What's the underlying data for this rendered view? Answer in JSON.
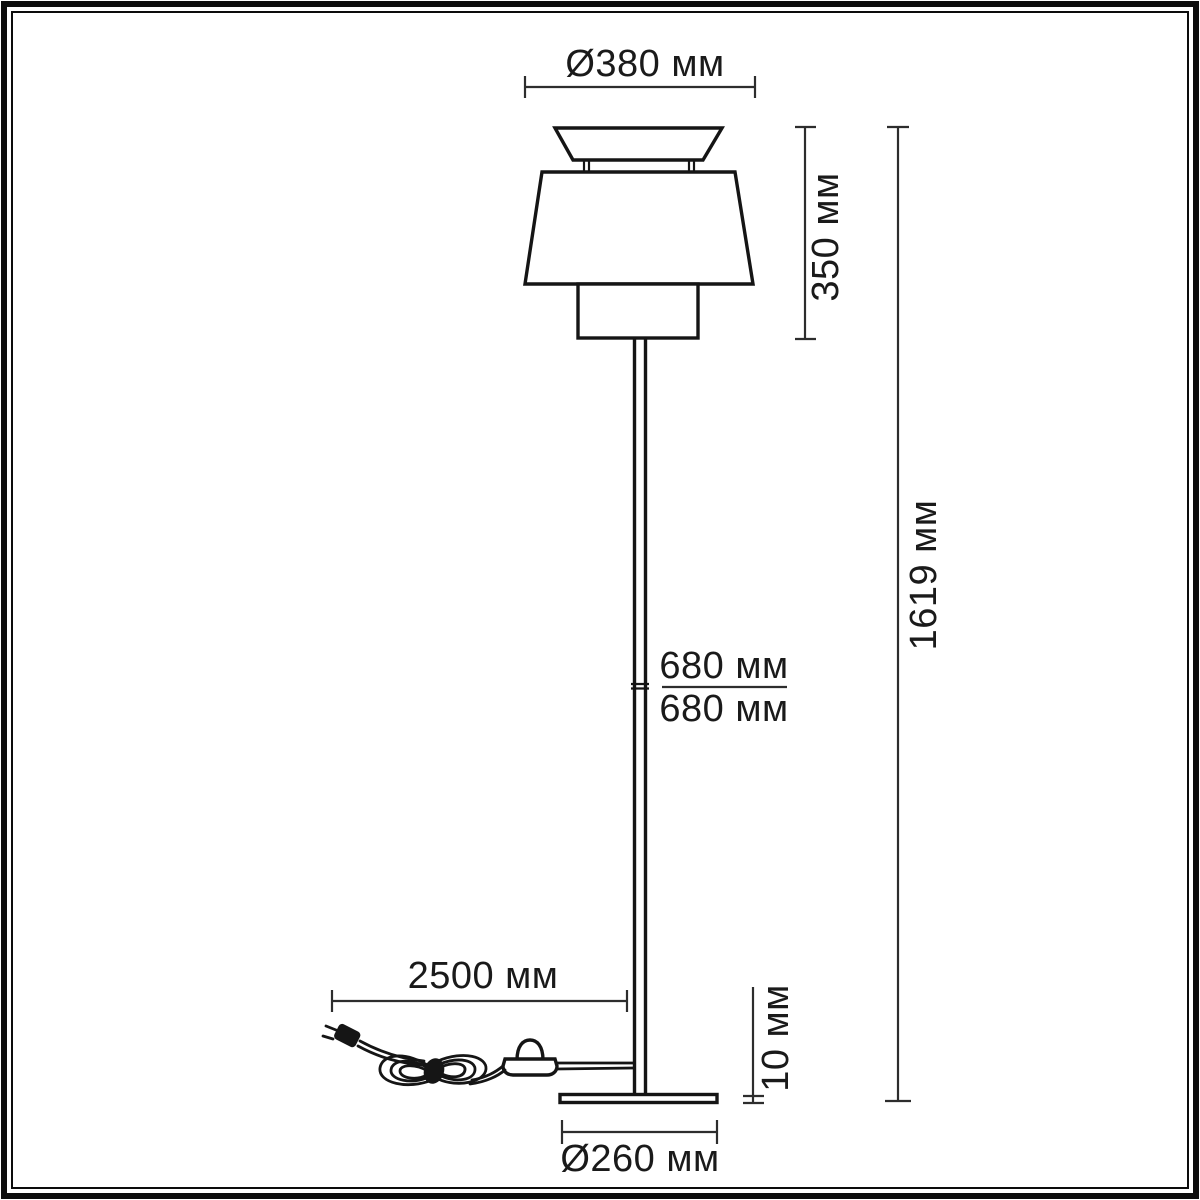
{
  "meta": {
    "type": "technical-dimension-drawing",
    "subject": "floor lamp with tiered shade, foot switch and round base",
    "units": "мм"
  },
  "labels": {
    "shade_diameter": "Ø380 мм",
    "shade_height": "350 мм",
    "total_height": "1619 мм",
    "upper_segment": "680 мм",
    "lower_segment": "680 мм",
    "cord_length": "2500 мм",
    "base_height": "10 мм",
    "base_diameter": "Ø260 мм"
  },
  "colors": {
    "background": "#ffffff",
    "frame": "#0c0c0c",
    "lamp_line": "#151515",
    "dimension_line": "#2d2d2d",
    "text": "#1a1a1a"
  }
}
